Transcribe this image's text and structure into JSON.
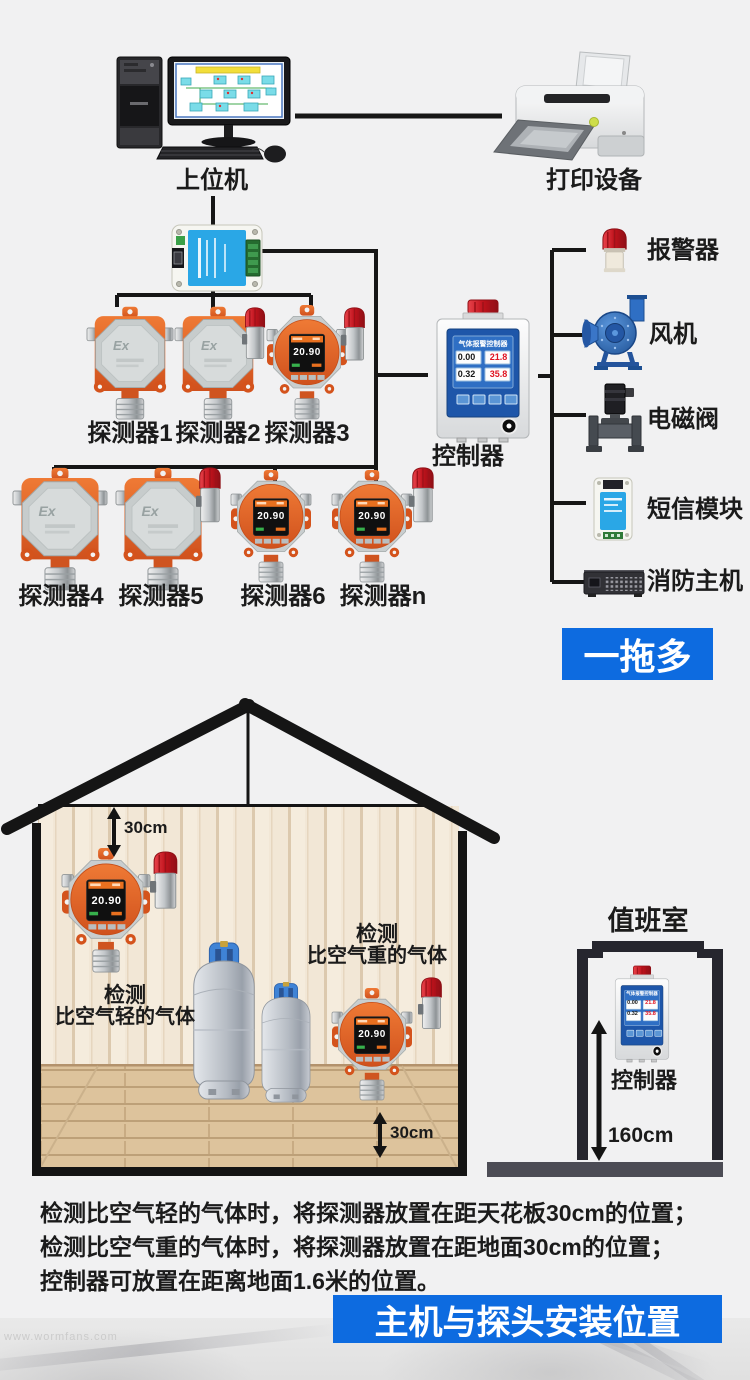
{
  "colors": {
    "accent_blue": "#0d6be0",
    "line_black": "#161616",
    "detector_orange": "#e0601f",
    "alarm_red": "#c11d24",
    "panel_blue": "#1e56a9"
  },
  "top": {
    "computer_label": "上位机",
    "printer_label": "打印设备",
    "row1": [
      "探测器1",
      "探测器2",
      "探测器3"
    ],
    "row2": [
      "探测器4",
      "探测器5",
      "探测器6",
      "探测器n"
    ],
    "controller": {
      "label": "控制器",
      "screen_title": "气体报警控制器",
      "readings": [
        "0.00",
        "21.8",
        "0.32",
        "35.8"
      ]
    },
    "right_devices": [
      "报警器",
      "风机",
      "电磁阀",
      "短信模块",
      "消防主机"
    ],
    "banner": "一拖多",
    "detector": {
      "ex_marking": "Ex",
      "display_value": "20.90"
    }
  },
  "house": {
    "clearance_top": "30cm",
    "clearance_bottom": "30cm",
    "light_gas_l1": "检测",
    "light_gas_l2": "比空气轻的气体",
    "heavy_gas_l1": "检测",
    "heavy_gas_l2": "比空气重的气体"
  },
  "duty_room": {
    "title": "值班室",
    "controller_label": "控制器",
    "height_label": "160cm"
  },
  "footer": {
    "line1": "检测比空气轻的气体时，将探测器放置在距天花板30cm的位置；",
    "line2": "检测比空气重的气体时，将探测器放置在距地面30cm的位置；",
    "line3": "控制器可放置在距离地面1.6米的位置。",
    "banner": "主机与探头安装位置",
    "watermark": "www.wormfans.com"
  }
}
